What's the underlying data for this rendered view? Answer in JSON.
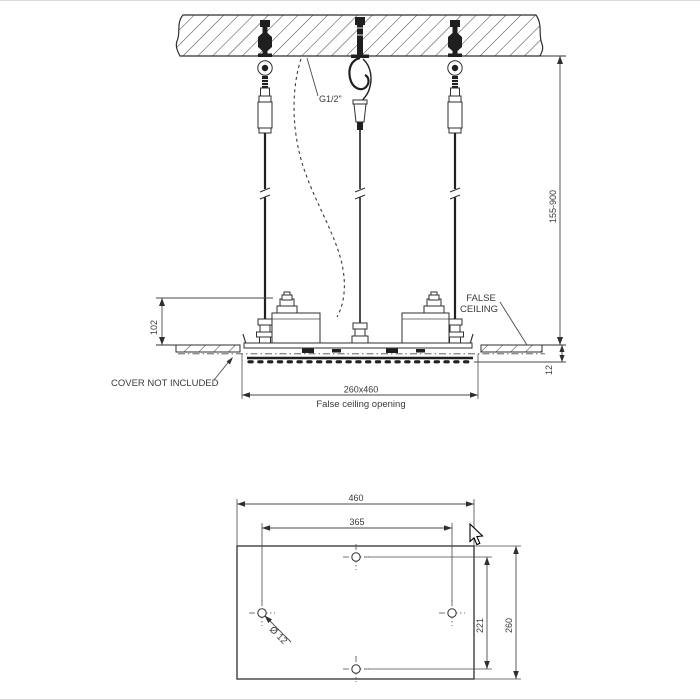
{
  "meta": {
    "description": "Ceiling-mounted shower head installation drawing",
    "background": "#ffffff",
    "line_color": "#2f2f2f",
    "text_color": "#3a3a3a"
  },
  "side_view": {
    "supply_thread_label": "G1/2\"",
    "suspension_range": "155-900",
    "body_height": "102",
    "false_ceiling_line1": "FALSE",
    "false_ceiling_line2": "CEILING",
    "cover_note": "COVER NOT INCLUDED",
    "panel_thickness": "12",
    "opening_size": "260x460",
    "opening_caption": "False ceiling opening"
  },
  "plan_view": {
    "overall_width": "460",
    "hole_spacing_horizontal": "365",
    "hole_spacing_vertical": "221",
    "overall_depth": "260",
    "hole_diameter": "Ø 12"
  }
}
